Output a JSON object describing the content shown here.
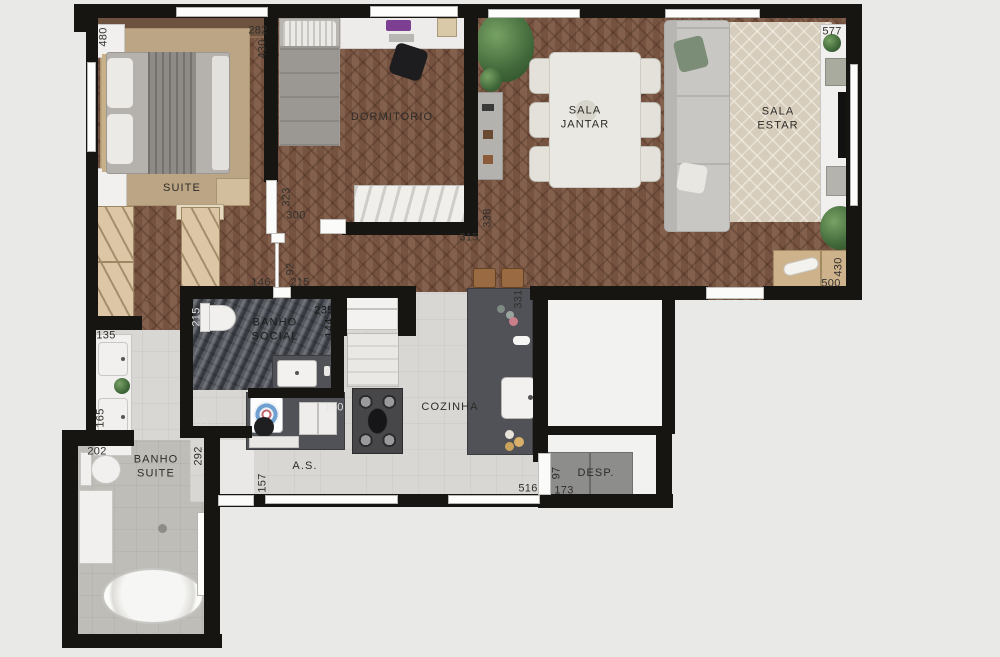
{
  "figure_type": "apartment-floor-plan",
  "rooms": {
    "suite": "SUITE",
    "dormitorio": "DORMITORIO",
    "sala_jantar": "SALA\nJANTAR",
    "sala_estar": "SALA\nESTAR",
    "banho_social": "BANHO\nSOCIAL",
    "cozinha": "COZINHA",
    "area_servico": "A.S.",
    "banho_suite": "BANHO\nSUITE",
    "despensa": "DESP."
  },
  "dims": {
    "suite_left": "480",
    "suite_right_a": "282",
    "suite_right_b": "430",
    "estar_top": "577",
    "dorm_left_a": "323",
    "dorm_left_b": "300",
    "dorm_bottom": "315",
    "dorm_right": "338",
    "hall_door": "92",
    "hall_left": "146",
    "hall_right": "215",
    "social_left": "215",
    "social_right_a": "235",
    "social_right_b": "144",
    "social_shower": "85",
    "vanity_a": "135",
    "vanity_b": "165",
    "bsuite_top": "202",
    "bsuite_right": "292",
    "as_left": "157",
    "as_tank": "150",
    "kitchen_bottom": "516",
    "desp_door_w": "97",
    "desp_door_l": "173",
    "kitchen_right": "331",
    "estar_cab_r": "430",
    "estar_cab_b": "500"
  },
  "colors": {
    "background": "#e9e9e8",
    "wall": "#171512",
    "wood_floor": "#7c5743",
    "bath_tile": "#4a4e55",
    "kitchen_floor": "#d9d7d3",
    "counter": "#505257",
    "label_text": "#32302c"
  }
}
